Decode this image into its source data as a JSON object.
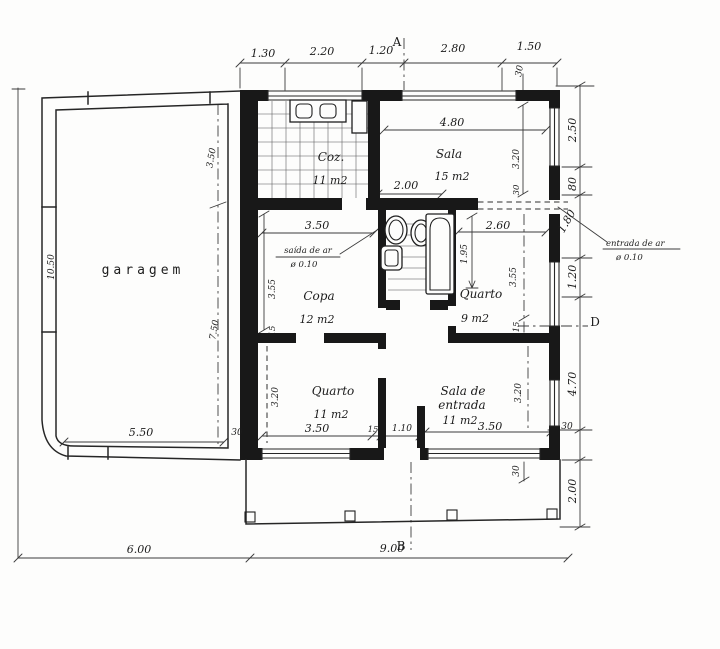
{
  "colors": {
    "ink": "#1c1c1c",
    "paper": "#fdfdfc"
  },
  "plan": {
    "sections": {
      "a": "A",
      "b": "B",
      "d": "D"
    },
    "rooms": {
      "garagem": {
        "label": "garagem"
      },
      "coz": {
        "label": "Coz.",
        "area": "11 m2"
      },
      "sala": {
        "label": "Sala",
        "area": "15 m2"
      },
      "copa": {
        "label": "Copa",
        "area": "12 m2"
      },
      "quarto9": {
        "label": "Quarto",
        "area": "9 m2"
      },
      "quarto11": {
        "label": "Quarto",
        "area": "11 m2"
      },
      "sala_entrada": {
        "label1": "Sala de",
        "label2": "entrada",
        "area": "11 m2"
      }
    },
    "annotations": {
      "saida1": "saída de ar",
      "saida2": "ø 0.10",
      "entrada1": "entrada de ar",
      "entrada2": "ø 0.10"
    },
    "dims": {
      "top1": "1.30",
      "top2": "2.20",
      "top3": "1.20",
      "top4": "2.80",
      "top5": "1.50",
      "top_wall": "30",
      "right1": "2.50",
      "right2": "80",
      "right3": "1.80",
      "right4": "1.20",
      "right5": "4.70",
      "right6": "30",
      "right7": "2.00",
      "sala_w": "4.80",
      "sala_h": "3.20",
      "sala_wall": "30",
      "bath_w": "2.00",
      "hall_w": "2.60",
      "bath_l": "1.95",
      "copa_w": "3.50",
      "copa_h": "3.55",
      "copa_wall": "15",
      "q9_h": "3.55",
      "q9_wall": "15",
      "q11_w": "3.50",
      "q11_h": "3.20",
      "q11_wall": "15",
      "vest_w": "1.10",
      "se_w": "3.50",
      "se_h": "3.20",
      "porch_wall": "30",
      "gar_h": "10.50",
      "gar_top": "3.50",
      "gar_bot": "7.50",
      "gar_w": "5.50",
      "gar_wall": "30",
      "bot1": "6.00",
      "bot2": "9.00"
    }
  }
}
